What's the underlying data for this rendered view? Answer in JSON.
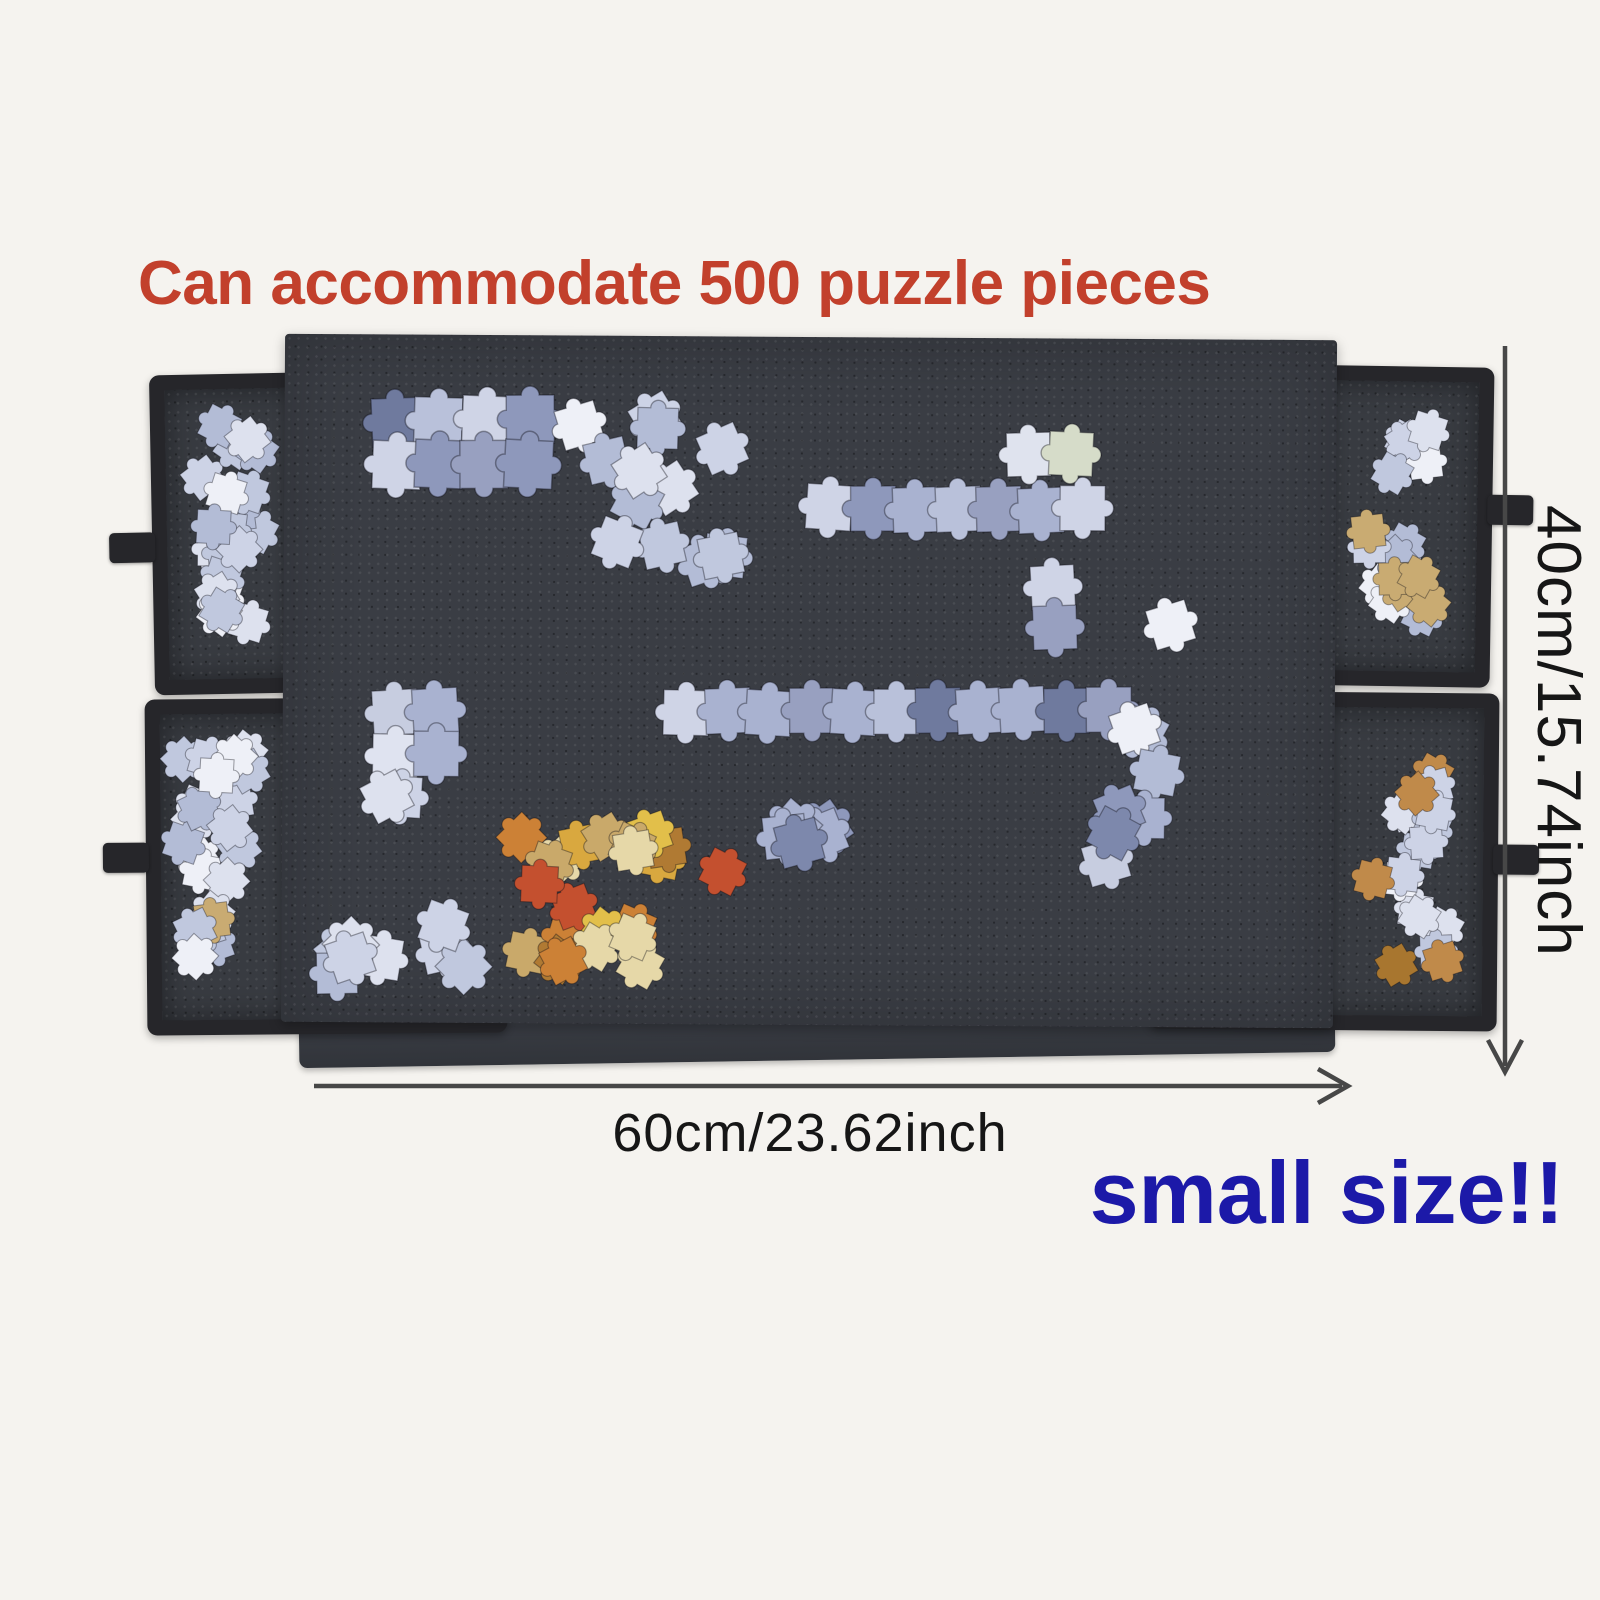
{
  "title": {
    "text": "Can accommodate 500 puzzle pieces"
  },
  "dimensions": {
    "height_label": "40cm/15.74inch",
    "width_label": "60cm/23.62inch"
  },
  "caption": {
    "text": "small size!!"
  },
  "colors": {
    "bg": "#f5f3ef",
    "title": "#c2402c",
    "board": "#3a3d44",
    "frame": "#26262a",
    "felt": "#383b41",
    "line": "#474747",
    "ink": "#161616",
    "blue": "#1c19a8"
  },
  "product": {
    "item": "felt jigsaw puzzle board",
    "tray_count": 4,
    "handle_count": 4
  },
  "scene": {
    "palettes": {
      "light": [
        "#dde1ee",
        "#cdd3e6",
        "#c0c8de",
        "#eef0f7",
        "#b3bcd6"
      ],
      "lightTan": [
        "#dde1ee",
        "#cdd3e6",
        "#c0c8de",
        "#eef0f7",
        "#b3bcd6",
        "#c9ab72"
      ],
      "lightWarm": [
        "#dde1ee",
        "#cdd3e6",
        "#c0c8de",
        "#eef0f7",
        "#c08a4a",
        "#a8762f"
      ],
      "image": [
        "#a9b2d0",
        "#8e98bb",
        "#b9c1da",
        "#6f7a9e",
        "#cfd4e6",
        "#98a0c0"
      ],
      "imageMix": [
        "#c7cde0",
        "#a9b2d0",
        "#8e98bb",
        "#dfe3f0",
        "#7d88ac"
      ],
      "paleGreen": [
        "#d6dcc9",
        "#c3cad8",
        "#dfe3ee"
      ],
      "warm": [
        "#e2bf4a",
        "#d9a83f",
        "#cc8136",
        "#c9a96a",
        "#c4502f",
        "#e6d8a8",
        "#b07a33"
      ]
    },
    "clusters": [
      {
        "name": "tray-tl-pieces",
        "layer": "under",
        "type": "scatter",
        "x": 166,
        "y": 398,
        "w": 112,
        "h": 238,
        "count": 22,
        "size": 46,
        "seed": 11,
        "palette": "light"
      },
      {
        "name": "tray-bl-pieces",
        "layer": "under",
        "type": "scatter",
        "x": 160,
        "y": 726,
        "w": 116,
        "h": 250,
        "count": 22,
        "size": 46,
        "seed": 22,
        "palette": "lightTan"
      },
      {
        "name": "tray-tr-pieces",
        "layer": "under",
        "type": "scatter",
        "x": 1342,
        "y": 392,
        "w": 104,
        "h": 240,
        "count": 18,
        "size": 44,
        "seed": 33,
        "palette": "lightTan"
      },
      {
        "name": "tray-br-pieces",
        "layer": "under",
        "type": "scatter",
        "x": 1348,
        "y": 716,
        "w": 106,
        "h": 258,
        "count": 18,
        "size": 44,
        "seed": 44,
        "palette": "lightWarm"
      },
      {
        "name": "board-block-topleft",
        "layer": "over",
        "type": "patch",
        "x": 362,
        "y": 388,
        "rows": 2,
        "cols": 4,
        "size": 66,
        "seed": 5,
        "palette": "image"
      },
      {
        "name": "board-scatter-top",
        "layer": "over",
        "type": "scatter",
        "x": 548,
        "y": 390,
        "w": 190,
        "h": 185,
        "count": 13,
        "size": 56,
        "seed": 6,
        "palette": "light"
      },
      {
        "name": "board-cross-horizontal",
        "layer": "over",
        "type": "patch",
        "x": 800,
        "y": 478,
        "rows": 1,
        "cols": 7,
        "size": 62,
        "seed": 7,
        "palette": "image"
      },
      {
        "name": "board-cross-top",
        "layer": "over",
        "type": "patch",
        "x": 1000,
        "y": 424,
        "rows": 1,
        "cols": 2,
        "size": 60,
        "seed": 8,
        "palette": "paleGreen"
      },
      {
        "name": "board-cross-bottom",
        "layer": "over",
        "type": "patch",
        "x": 1024,
        "y": 556,
        "rows": 2,
        "cols": 1,
        "size": 60,
        "seed": 9,
        "palette": "image"
      },
      {
        "name": "board-strip",
        "layer": "over",
        "type": "patch",
        "x": 655,
        "y": 680,
        "rows": 1,
        "cols": 11,
        "size": 62,
        "seed": 10,
        "palette": "image"
      },
      {
        "name": "board-strip-tail",
        "layer": "over",
        "type": "scatter",
        "x": 1098,
        "y": 700,
        "w": 95,
        "h": 100,
        "count": 3,
        "size": 56,
        "seed": 12,
        "palette": "light"
      },
      {
        "name": "board-block-midleft",
        "layer": "over",
        "type": "patch",
        "x": 364,
        "y": 682,
        "rows": 2,
        "cols": 2,
        "size": 62,
        "seed": 13,
        "palette": "imageMix"
      },
      {
        "name": "board-loose-midleft",
        "layer": "over",
        "type": "scatter",
        "x": 348,
        "y": 762,
        "w": 95,
        "h": 55,
        "count": 2,
        "size": 56,
        "seed": 14,
        "palette": "light"
      },
      {
        "name": "board-cluster-bottom-mid",
        "layer": "over",
        "type": "scatter",
        "x": 752,
        "y": 788,
        "w": 225,
        "h": 68,
        "count": 5,
        "size": 58,
        "seed": 15,
        "palette": "imageMix"
      },
      {
        "name": "board-cluster-right",
        "layer": "over",
        "type": "scatter",
        "x": 1062,
        "y": 782,
        "w": 125,
        "h": 95,
        "count": 4,
        "size": 56,
        "seed": 16,
        "palette": "imageMix"
      },
      {
        "name": "board-colorful-cluster",
        "layer": "over",
        "type": "scatter",
        "x": 482,
        "y": 802,
        "w": 262,
        "h": 200,
        "count": 22,
        "size": 50,
        "seed": 17,
        "palette": "warm"
      },
      {
        "name": "board-cluster-bottom-left",
        "layer": "over",
        "type": "scatter",
        "x": 292,
        "y": 870,
        "w": 192,
        "h": 138,
        "count": 8,
        "size": 56,
        "seed": 18,
        "palette": "light"
      },
      {
        "name": "board-single-piece",
        "layer": "over",
        "type": "scatter",
        "x": 1142,
        "y": 596,
        "w": 52,
        "h": 42,
        "count": 1,
        "size": 56,
        "seed": 19,
        "palette": "light"
      }
    ]
  }
}
